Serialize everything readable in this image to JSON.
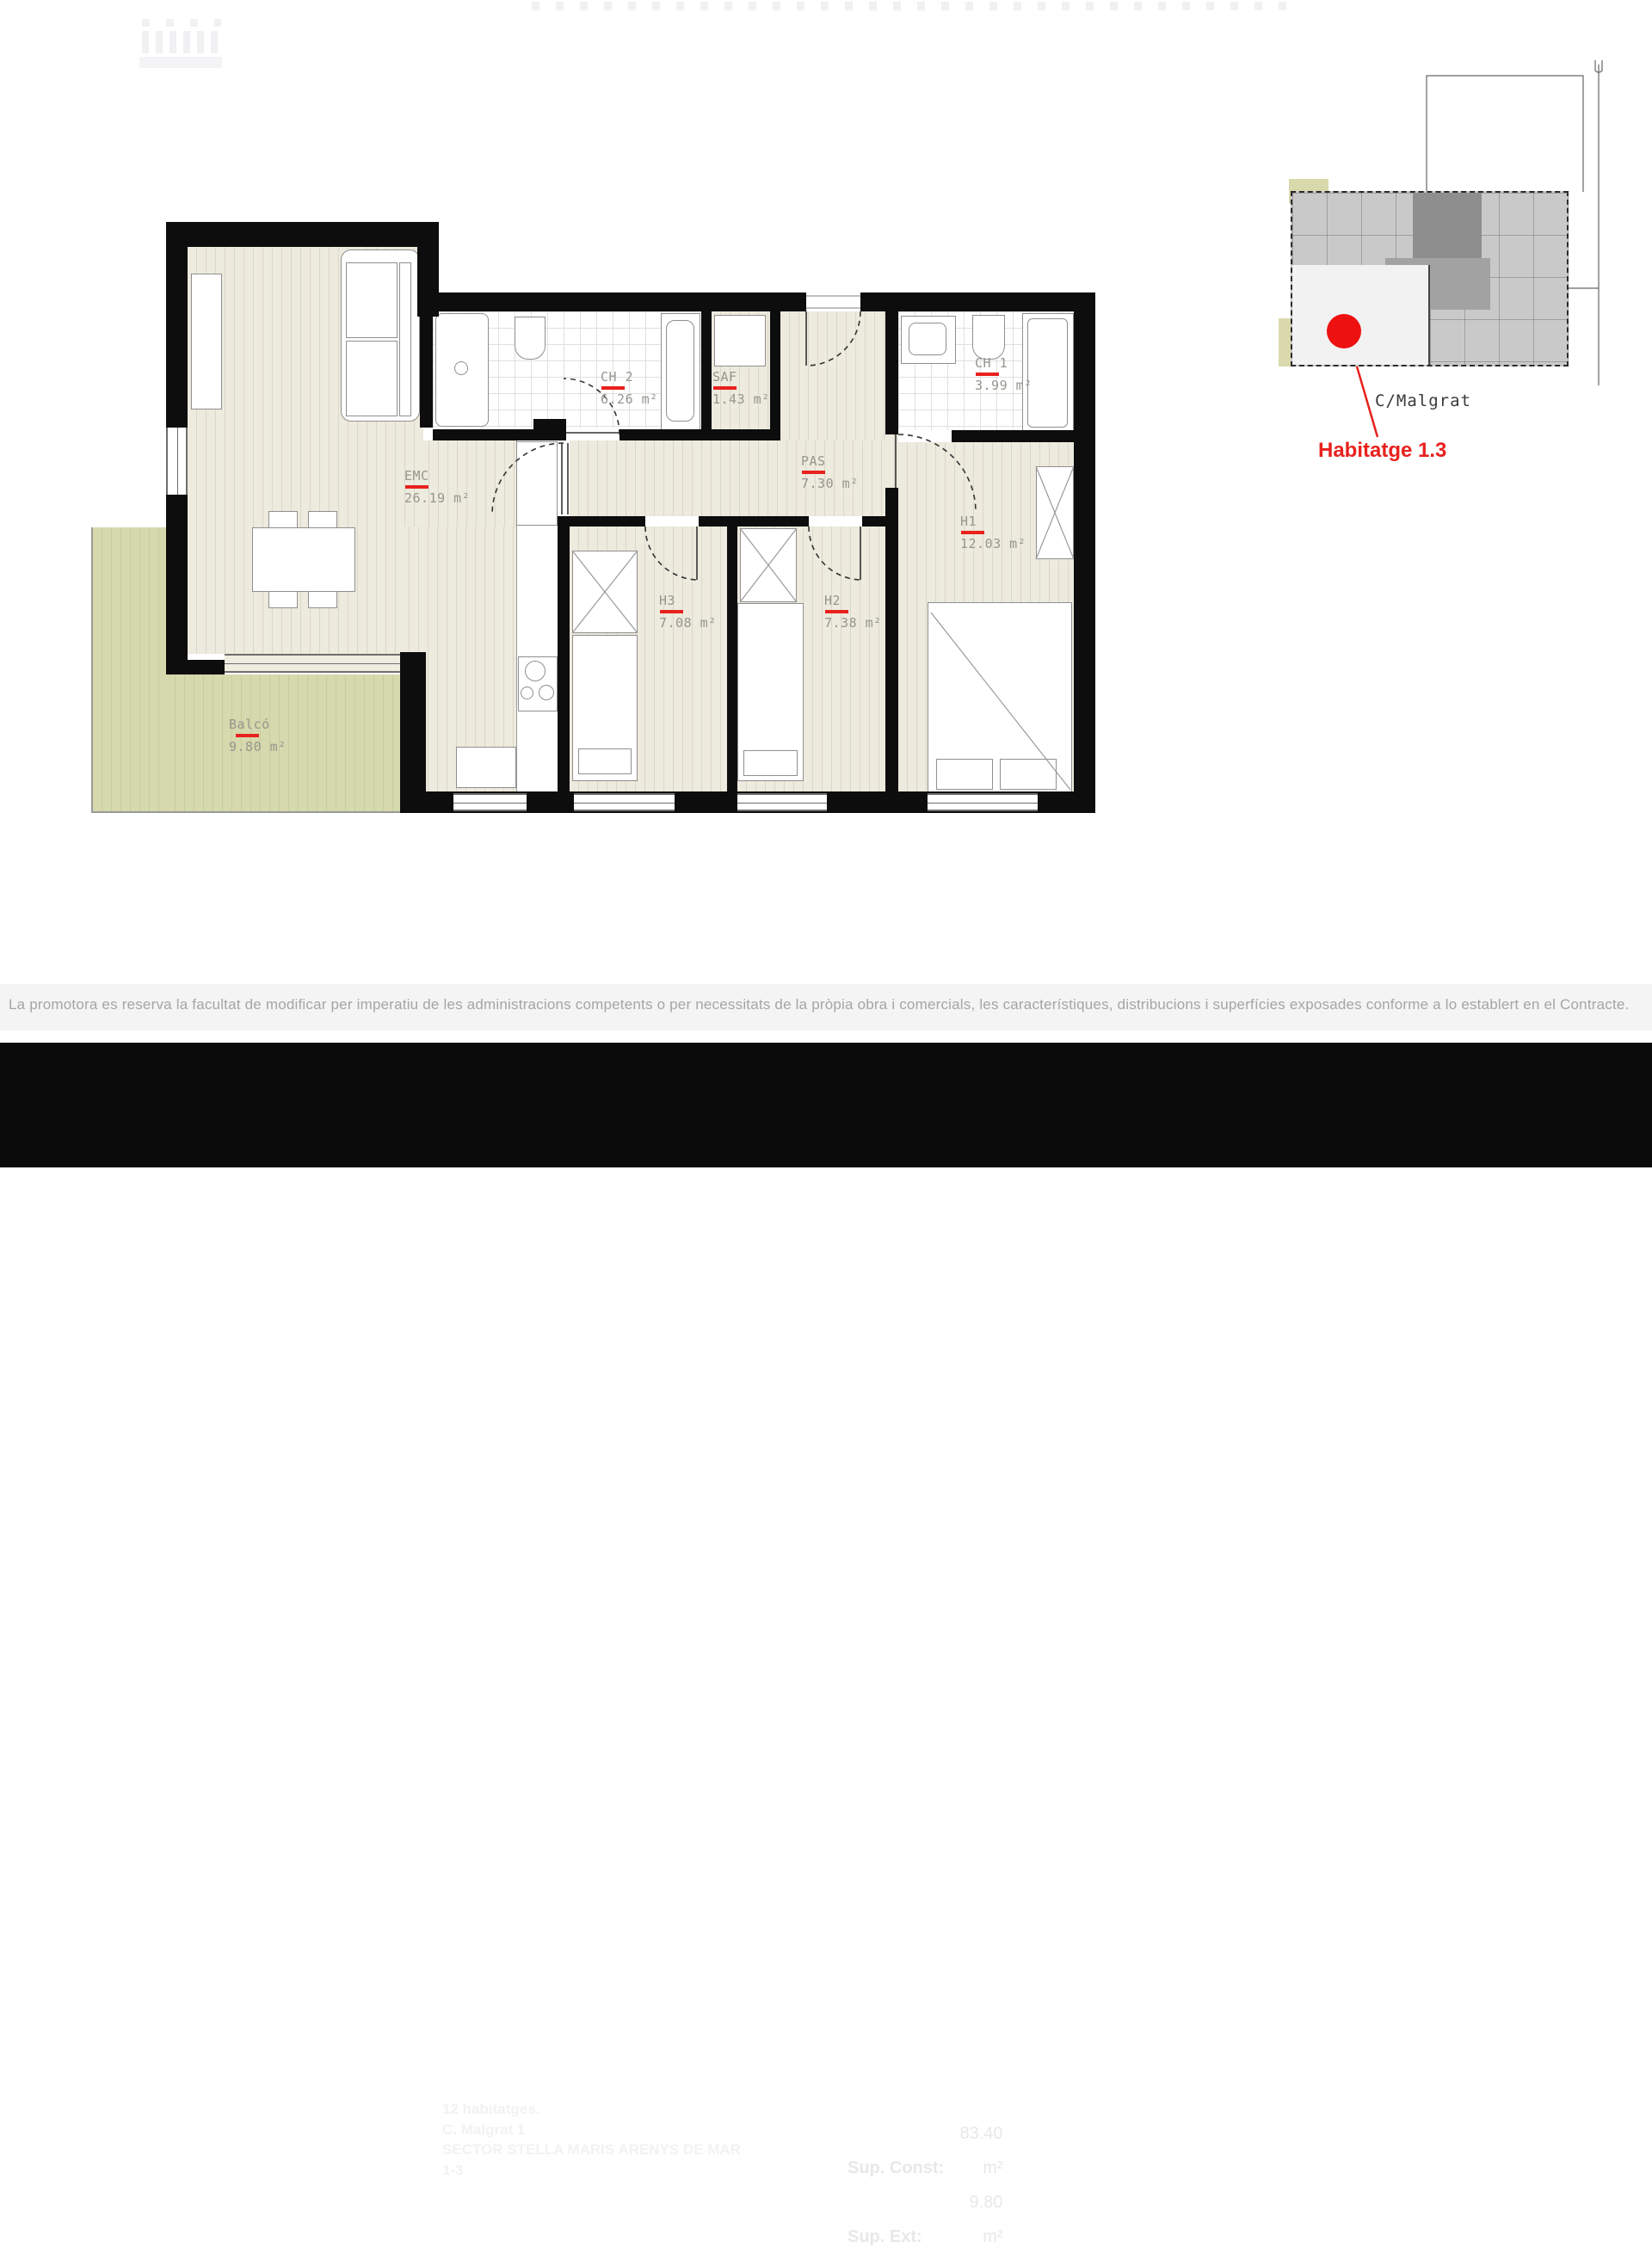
{
  "plan": {
    "rooms": [
      {
        "id": "emc",
        "name": "EMC",
        "area": "26.19 m²"
      },
      {
        "id": "ch2",
        "name": "CH 2",
        "area": "6.26 m²"
      },
      {
        "id": "saf",
        "name": "SAF",
        "area": "1.43 m²"
      },
      {
        "id": "pas",
        "name": "PAS",
        "area": "7.30 m²"
      },
      {
        "id": "ch1",
        "name": "CH 1",
        "area": "3.99 m²"
      },
      {
        "id": "h1",
        "name": "H1",
        "area": "12.03 m²"
      },
      {
        "id": "h3",
        "name": "H3",
        "area": "7.08 m²"
      },
      {
        "id": "h2",
        "name": "H2",
        "area": "7.38 m²"
      },
      {
        "id": "balco",
        "name": "Balcó",
        "area": "9.80 m²"
      }
    ],
    "colors": {
      "accent_red": "#e8211d",
      "wall": "#0d0d0d",
      "floor": "#edeade",
      "floor_line": "#dbd7c9",
      "balcony": "#d6d9ad",
      "balcony_line": "#c7cc9e",
      "label": "#97958e",
      "footer_bg": "#0b0b0b"
    }
  },
  "keyplan": {
    "street_label": "C/Malgrat",
    "unit_label": "Habitatge 1.3"
  },
  "disclaimer": "La promotora es reserva la facultat de modificar per imperatiu de les administracions competents o per necessitats de la pròpia obra i comercials, les característiques, distribucions i superfícies exposades conforme a lo establert en el Contracte.",
  "footer": {
    "brand": "LuxHabitat",
    "project_lines": [
      "12 habitatges.",
      "C. Malgrat 1",
      "SECTOR STELLA MARIS ARENYS DE MAR",
      "1-3"
    ],
    "sup_const_label": "Sup. Const:",
    "sup_const_value": "83.40 m²",
    "sup_ext_label": "Sup. Ext:",
    "sup_ext_value": "9.80 m²",
    "north_label": "N.",
    "logo_right_line1": "Lux Stella",
    "logo_right_line2": "Maris"
  }
}
